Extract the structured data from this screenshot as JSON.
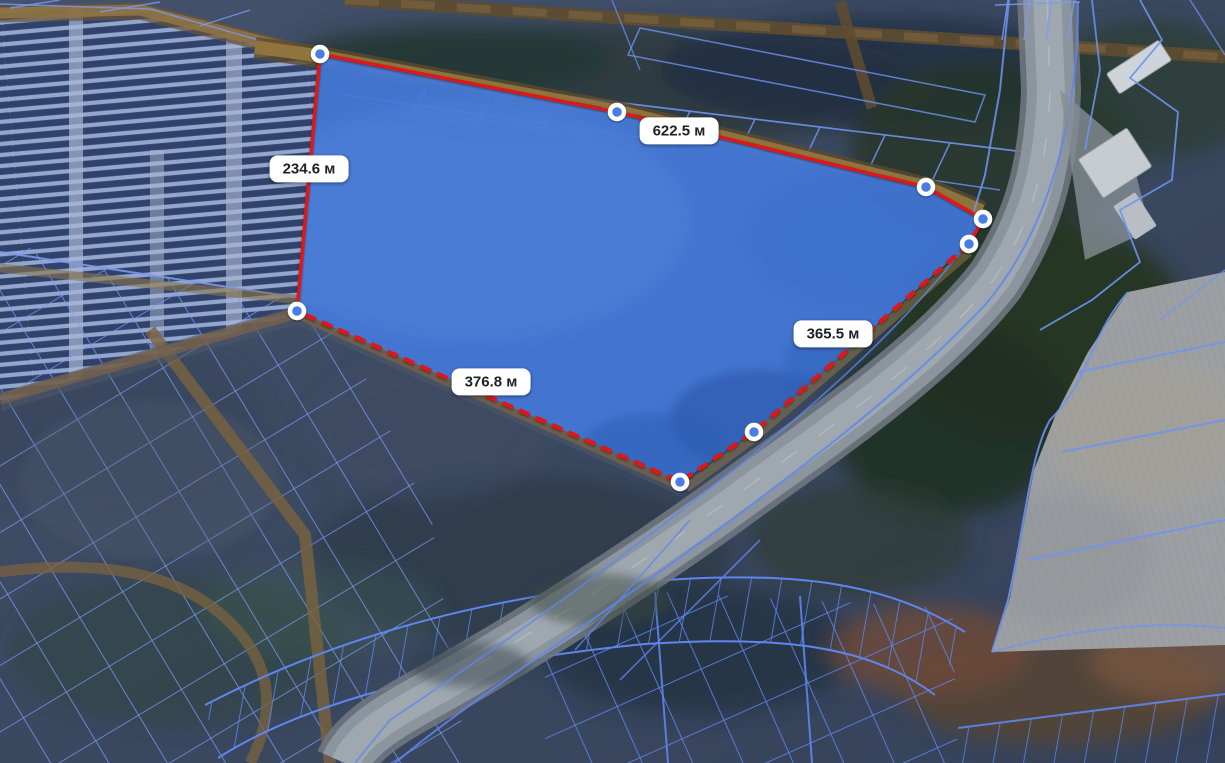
{
  "app": {
    "view": "satellite map with cadastral parcel overlay and area measurement tool"
  },
  "measurement": {
    "unit": "м",
    "segments": [
      {
        "name": "top-edge-length",
        "label": "622.5 м",
        "label_x": 679,
        "label_y": 131
      },
      {
        "name": "left-edge-length",
        "label": "234.6 м",
        "label_x": 309,
        "label_y": 169
      },
      {
        "name": "bottom-edge-length",
        "label": "376.8 м",
        "label_x": 491,
        "label_y": 382
      },
      {
        "name": "right-edge-length",
        "label": "365.5 м",
        "label_x": 833,
        "label_y": 334
      }
    ],
    "polygon": {
      "vertices": [
        [
          320,
          54
        ],
        [
          617,
          112
        ],
        [
          926,
          187
        ],
        [
          983,
          219
        ],
        [
          969,
          244
        ],
        [
          754,
          432
        ],
        [
          680,
          482
        ],
        [
          297,
          311
        ]
      ],
      "solid_chain": [
        7,
        0,
        1,
        2,
        3,
        4
      ],
      "dashed_chain": [
        4,
        5,
        6,
        7
      ],
      "fill_color": "#4478d8",
      "fill_opacity": 0.93,
      "stroke_color": "#e11616",
      "solid_width": 3.4,
      "dashed_width": 4.2,
      "dash_pattern": "11 7",
      "vertex_radius": 7,
      "vertex_fill": "#4a7ce4",
      "vertex_ring": "#ffffff",
      "vertex_ring_width": 4.5
    }
  },
  "colors": {
    "cadastral_line": "#7b9af2",
    "cadastral_line_dark": "#5f85ee",
    "label_bg": "#ffffff",
    "label_text": "#202124",
    "measure_red": "#e11616",
    "highway_grey": "#8c959e",
    "dirt_road_tan": "#96793f"
  }
}
